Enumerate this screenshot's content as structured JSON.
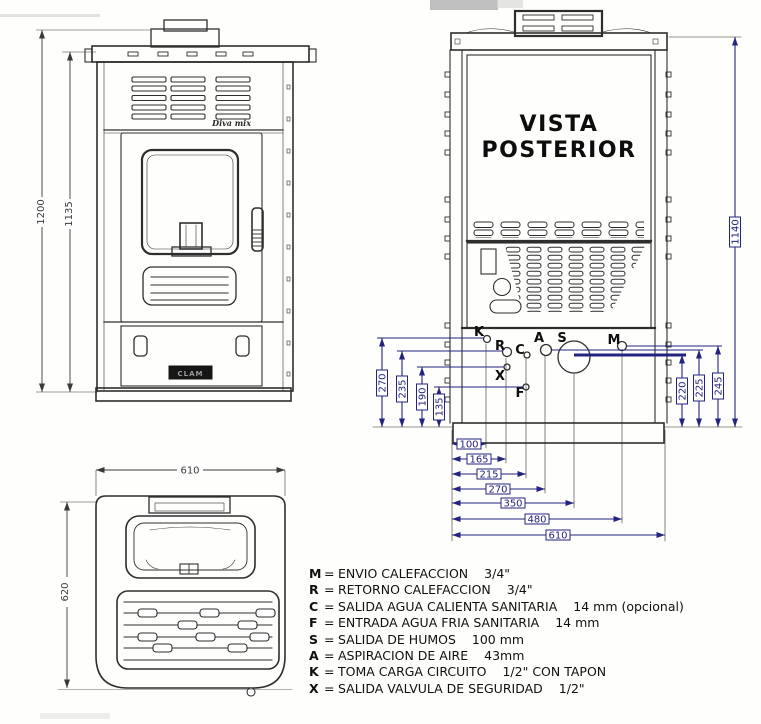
{
  "front_view": {
    "model_badge": "Diva mix",
    "brand_badge": "CLAM"
  },
  "rear_view": {
    "title_line1": "VISTA",
    "title_line2": "POSTERIOR"
  },
  "dimensions": {
    "front": {
      "total_height": "1200",
      "body_height": "1135"
    },
    "rear": {
      "height": "1140",
      "left_vertical": [
        "270",
        "235",
        "190",
        "135"
      ],
      "right_vertical": [
        "220",
        "225",
        "245"
      ],
      "bottom_horizontal": [
        "100",
        "165",
        "215",
        "270",
        "350",
        "480",
        "610"
      ]
    },
    "top": {
      "width": "610",
      "depth": "620"
    }
  },
  "ports": [
    {
      "letter": "K"
    },
    {
      "letter": "R"
    },
    {
      "letter": "C"
    },
    {
      "letter": "A"
    },
    {
      "letter": "S"
    },
    {
      "letter": "M"
    },
    {
      "letter": "X"
    },
    {
      "letter": "F"
    }
  ],
  "legend": {
    "separator": "=",
    "items": [
      {
        "letter": "M",
        "description": "ENVIO CALEFACCION",
        "size": "3/4\""
      },
      {
        "letter": "R",
        "description": "RETORNO CALEFACCION",
        "size": "3/4\""
      },
      {
        "letter": "C",
        "description": "SALIDA AGUA CALIENTA SANITARIA",
        "size": "14 mm (opcional)"
      },
      {
        "letter": "F",
        "description": "ENTRADA AGUA FRIA SANITARIA",
        "size": "14 mm"
      },
      {
        "letter": "S",
        "description": "SALIDA DE HUMOS",
        "size": "100 mm"
      },
      {
        "letter": "A",
        "description": "ASPIRACION DE AIRE",
        "size": "43mm"
      },
      {
        "letter": "K",
        "description": "TOMA CARGA CIRCUITO",
        "size": "1/2\" CON TAPON"
      },
      {
        "letter": "X",
        "description": "SALIDA VALVULA DE SEGURIDAD",
        "size": "1/2\""
      }
    ]
  },
  "colors": {
    "dimension_blue": "#232380",
    "drawing_line": "#2e2e2e",
    "background": "#fefefc"
  }
}
